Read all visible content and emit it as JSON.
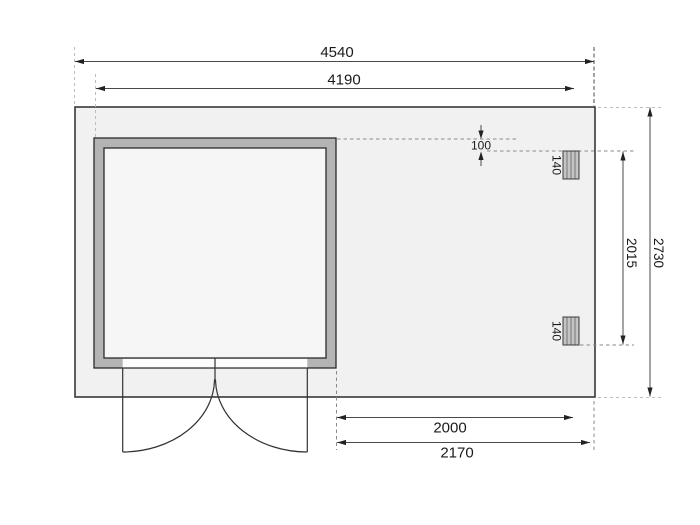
{
  "dimensions": {
    "total_width": "4540",
    "inner_width": "4190",
    "post_span_depth": "2015",
    "total_depth": "2730",
    "annex_width": "2000",
    "annex_total_width": "2170",
    "front_offset": "100",
    "post_width_top": "140",
    "post_width_bottom": "140"
  },
  "colors": {
    "platform_fill": "#f1f1f1",
    "wall_fill": "#b4b4b4",
    "room_fill": "#f6f6f6",
    "opening_fill": "#fcfcfc",
    "post_fill": "#c4c4c4",
    "outline": "#2b2b2b",
    "dim_line": "#4a4a4a",
    "text": "#1a1a1a"
  }
}
